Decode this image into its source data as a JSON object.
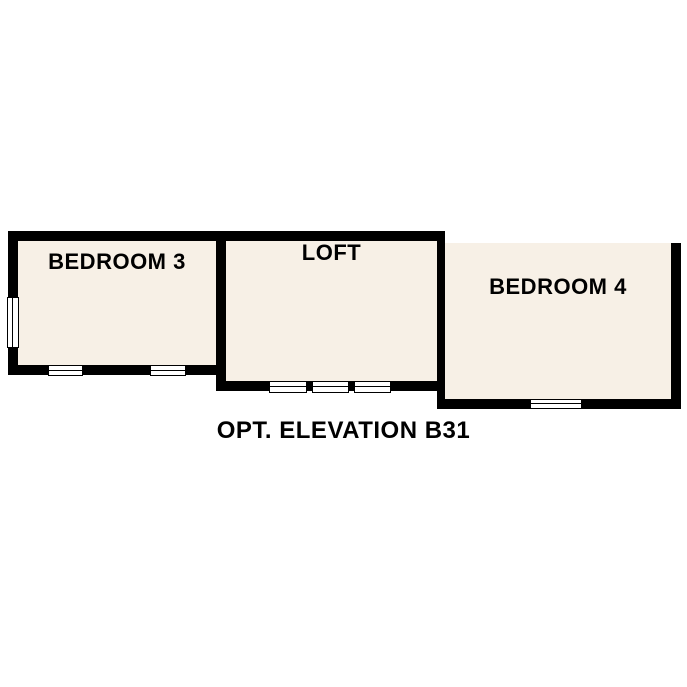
{
  "plan": {
    "caption": "OPT. ELEVATION B31",
    "rooms": [
      {
        "label": "BEDROOM 3"
      },
      {
        "label": "LOFT"
      },
      {
        "label": "BEDROOM 4"
      }
    ],
    "window_symbol_count": 7
  },
  "colors": {
    "wall": "#000000",
    "floor_fill": "#f7f0e6",
    "background": "#ffffff",
    "text": "#000000",
    "window_fill": "#ffffff"
  }
}
